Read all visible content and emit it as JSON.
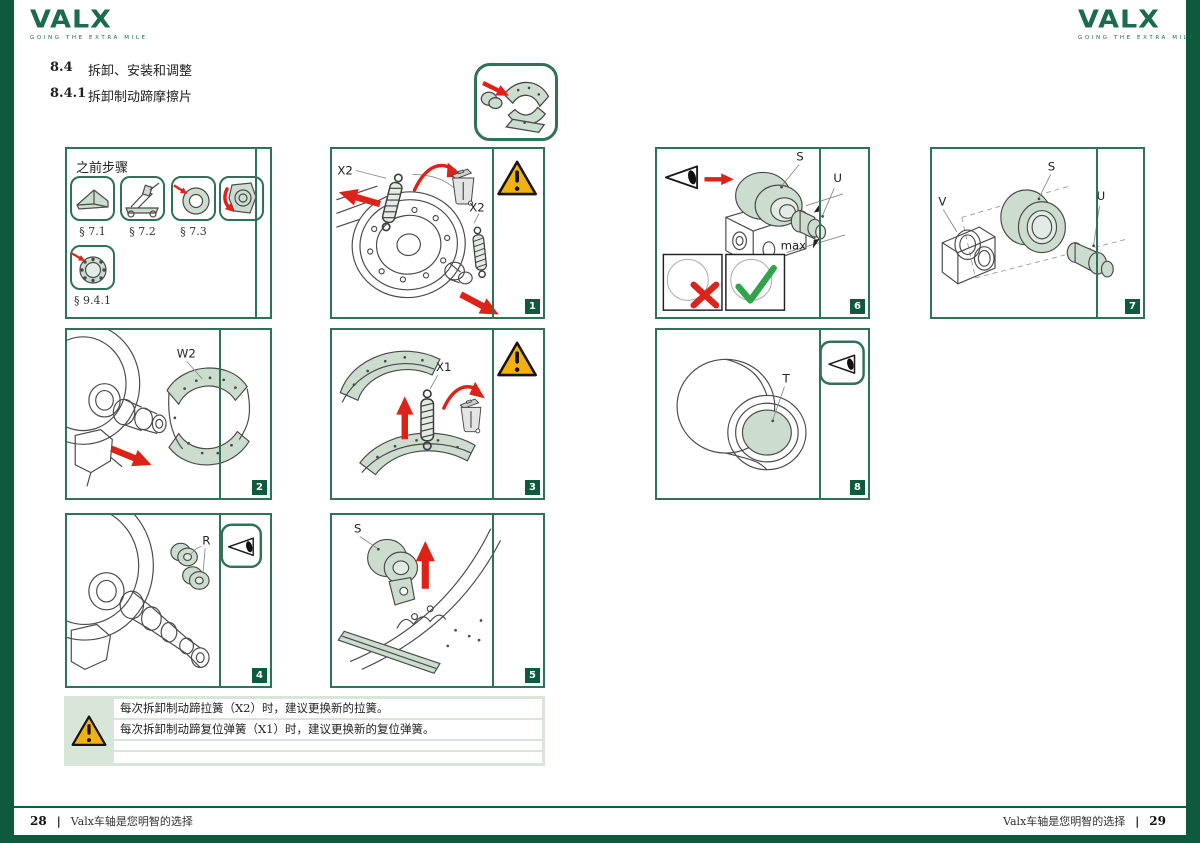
{
  "brand": {
    "logo_text": "VALX",
    "tagline": "GOING THE EXTRA MILE"
  },
  "headings": {
    "section_number": "8.4",
    "section_title": "拆卸、安装和调整",
    "subsection_number": "8.4.1",
    "subsection_title": "拆卸制动蹄摩擦片"
  },
  "prev_steps": {
    "title": "之前步骤",
    "refs": [
      "§ 7.1",
      "§ 7.2",
      "§ 7.3",
      "§ 9.4.1"
    ]
  },
  "panels": {
    "p1": {
      "number": "1",
      "label_spring_top": "X2",
      "label_spring_right": "X2"
    },
    "p2": {
      "number": "2",
      "label_shoes": "W2"
    },
    "p3": {
      "number": "3",
      "label_spring": "X1"
    },
    "p4": {
      "number": "4",
      "label_rollers": "R"
    },
    "p5": {
      "number": "5",
      "label_roller": "S"
    },
    "p6": {
      "number": "6",
      "label_roller": "S",
      "label_pin": "U",
      "label_max": "max"
    },
    "p7": {
      "number": "7",
      "label_bracket": "V",
      "label_roller": "S",
      "label_pin": "U"
    },
    "p8": {
      "number": "8",
      "label_bore": "T"
    }
  },
  "warning_box": {
    "line1": "每次拆卸制动蹄拉簧（X2）时，建议更换新的拉簧。",
    "line2": "每次拆卸制动蹄复位弹簧（X1）时，建议更换新的复位弹簧。",
    "line3": "",
    "line4": ""
  },
  "footer": {
    "left_page_number": "28",
    "left_tagline": "Valx车轴是您明智的选择",
    "right_tagline": "Valx车轴是您明智的选择",
    "right_page_number": "29",
    "divider": "|"
  },
  "icons": {
    "warning": "triangle-exclamation",
    "disposal": "waste-bin",
    "inspect": "eye",
    "wrong": "✕",
    "correct": "✓"
  },
  "colors": {
    "brand_green": "#1b6b4f",
    "panel_border": "#2f7257",
    "edge_green": "#0d5a3d",
    "accent_red": "#dd2318",
    "warning_yellow": "#f2b10e",
    "tint_green": "#ccddd0"
  }
}
